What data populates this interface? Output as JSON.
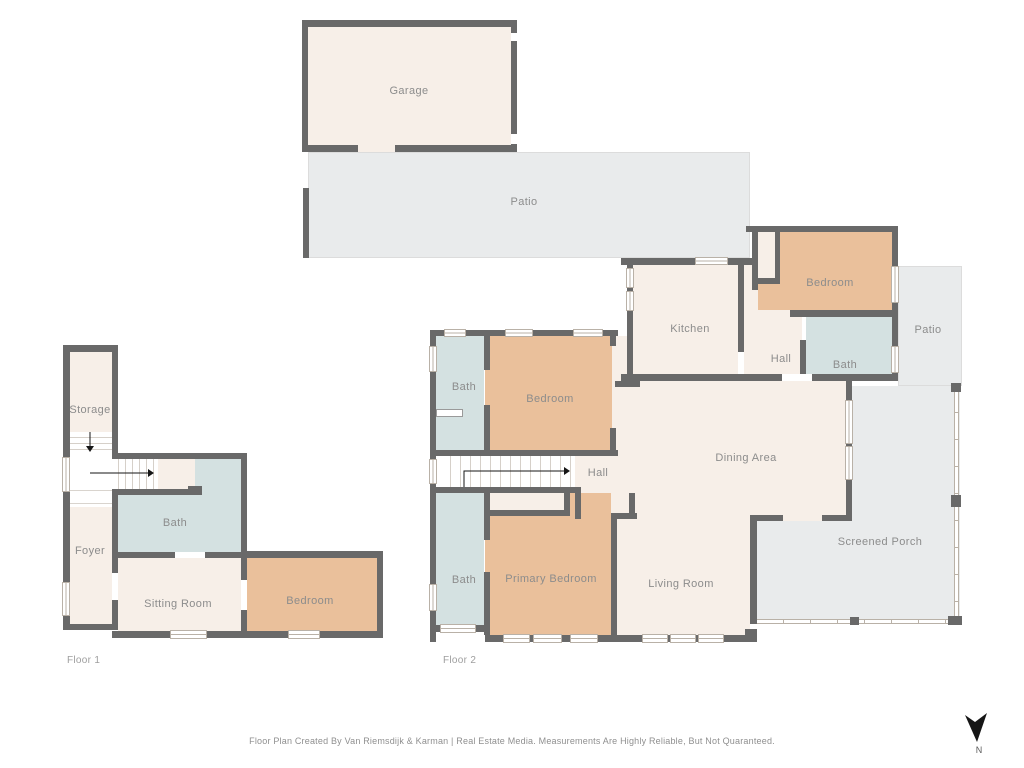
{
  "outdoor": {
    "garage": "Garage",
    "patio": "Patio"
  },
  "floor1": {
    "label": "Floor 1",
    "storage": "Storage",
    "foyer": "Foyer",
    "bath": "Bath",
    "sitting_room": "Sitting Room",
    "bedroom": "Bedroom"
  },
  "floor2": {
    "label": "Floor 2",
    "kitchen": "Kitchen",
    "bedroom_top_right": "Bedroom",
    "bedroom_left": "Bedroom",
    "primary_bedroom": "Primary Bedroom",
    "bath_top_left": "Bath",
    "bath_bottom_left": "Bath",
    "bath_right": "Bath",
    "hall_center": "Hall",
    "hall_right": "Hall",
    "dining_area": "Dining Area",
    "living_room": "Living Room",
    "screened_porch": "Screened Porch",
    "patio": "Patio"
  },
  "compass": {
    "label": "N"
  },
  "footer": "Floor Plan Created By Van Riemsdijk & Karman | Real Estate Media. Measurements Are Highly Reliable, But Not Quaranteed.",
  "colors": {
    "wall": "#696969",
    "room": "#f7efe8",
    "bedroom": "#eac09b",
    "bath": "#d4e1e1",
    "outdoor": "#e9ebec",
    "label": "#8c8c8c"
  }
}
